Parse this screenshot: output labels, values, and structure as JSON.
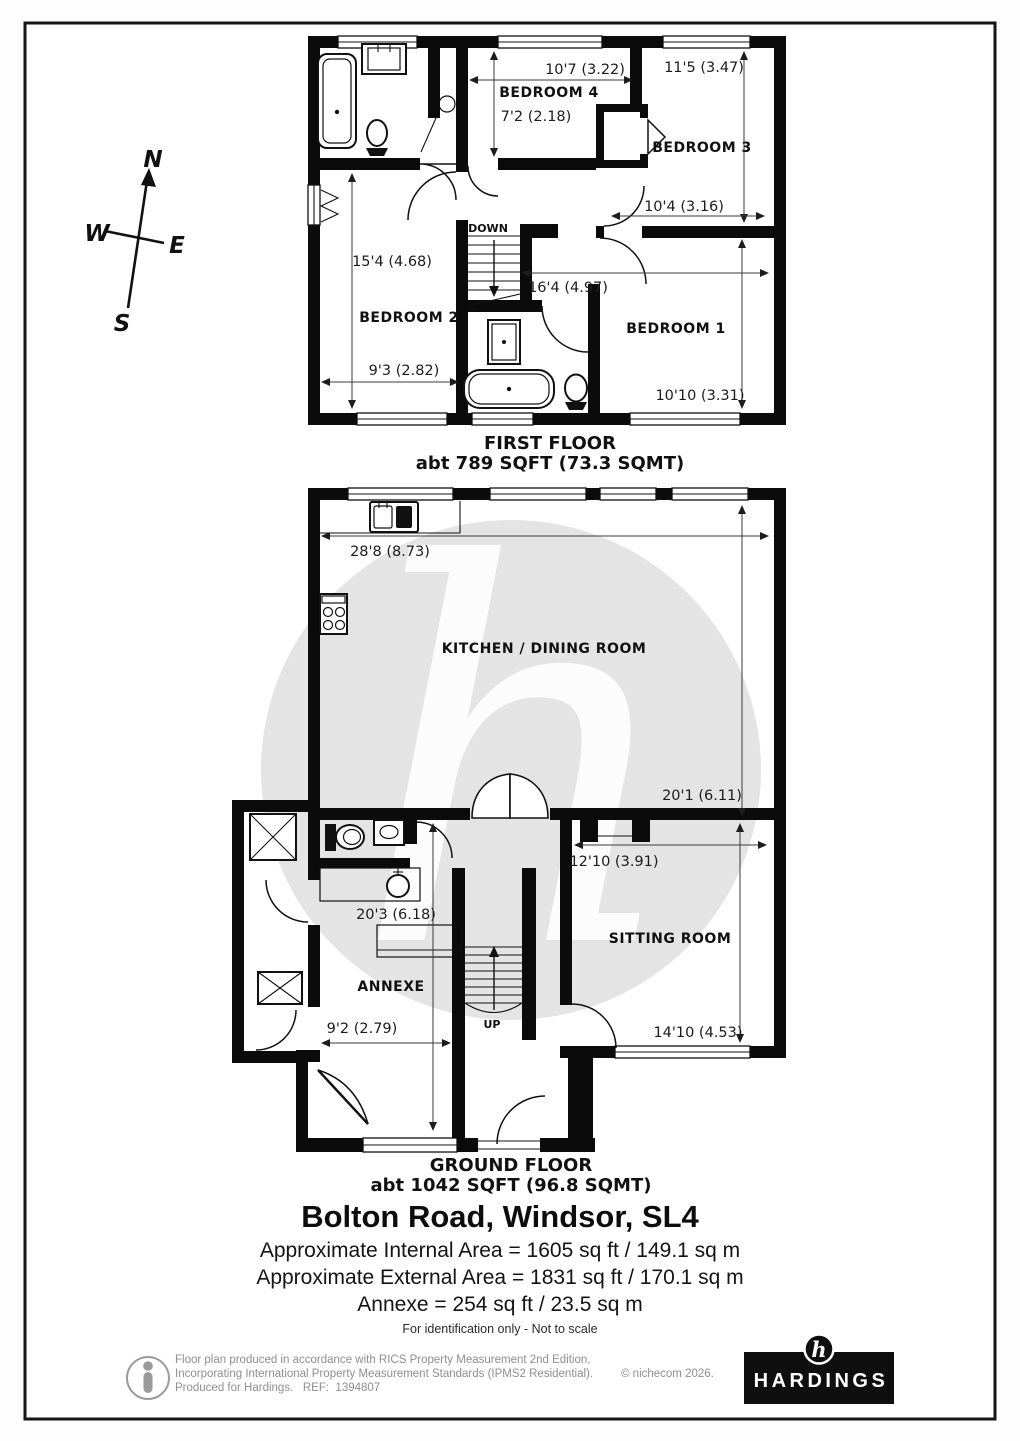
{
  "colors": {
    "wall": "#0b0b0b",
    "watermark_circle": "#e4e4e4",
    "watermark_letter": "#fcfcfc",
    "footer_text": "#8f8f8f",
    "brand_bg": "#0f0f0f",
    "brand_text": "#ffffff"
  },
  "compass": {
    "north": "N",
    "east": "E",
    "south": "S",
    "west": "W"
  },
  "first_floor": {
    "title": "FIRST FLOOR",
    "area": "abt 789 SQFT (73.3 SQMT)",
    "stairs": "DOWN",
    "bedroom4": {
      "name": "BEDROOM 4",
      "width": "10'7 (3.22)",
      "depth": "7'2 (2.18)"
    },
    "bedroom3": {
      "name": "BEDROOM 3",
      "height": "11'5 (3.47)",
      "width": "10'4 (3.16)"
    },
    "bedroom2": {
      "name": "BEDROOM 2",
      "height": "15'4 (4.68)",
      "width": "9'3 (2.82)"
    },
    "bedroom1": {
      "name": "BEDROOM 1",
      "width": "16'4 (4.97)",
      "height": "10'10 (3.31)"
    }
  },
  "ground_floor": {
    "title": "GROUND FLOOR",
    "area": "abt 1042 SQFT (96.8 SQMT)",
    "stairs": "UP",
    "kitchen": {
      "name": "KITCHEN / DINING ROOM",
      "width": "28'8 (8.73)",
      "height": "20'1 (6.11)"
    },
    "annexe": {
      "name": "ANNEXE",
      "height": "20'3 (6.18)",
      "width": "9'2 (2.79)"
    },
    "sitting": {
      "name": "SITTING ROOM",
      "width": "12'10 (3.91)",
      "height": "14'10 (4.53)"
    }
  },
  "summary": {
    "address": "Bolton Road, Windsor, SL4",
    "internal": "Approximate Internal Area = 1605 sq ft / 149.1 sq m",
    "external": "Approximate External Area = 1831 sq ft / 170.1 sq m",
    "annexe": "Annexe = 254 sq ft / 23.5 sq m",
    "note": "For identification only - Not to scale"
  },
  "watermark": "h",
  "footer": {
    "line1": "Floor plan produced in accordance with RICS Property Measurement 2nd Edition,",
    "line2": "Incorporating International Property Measurement Standards (IPMS2 Residential).",
    "line3": "Produced for Hardings.   REF:  1394807",
    "copyright": "© nichecom 2026.",
    "brand": "HARDINGS",
    "brand_initial": "h"
  }
}
